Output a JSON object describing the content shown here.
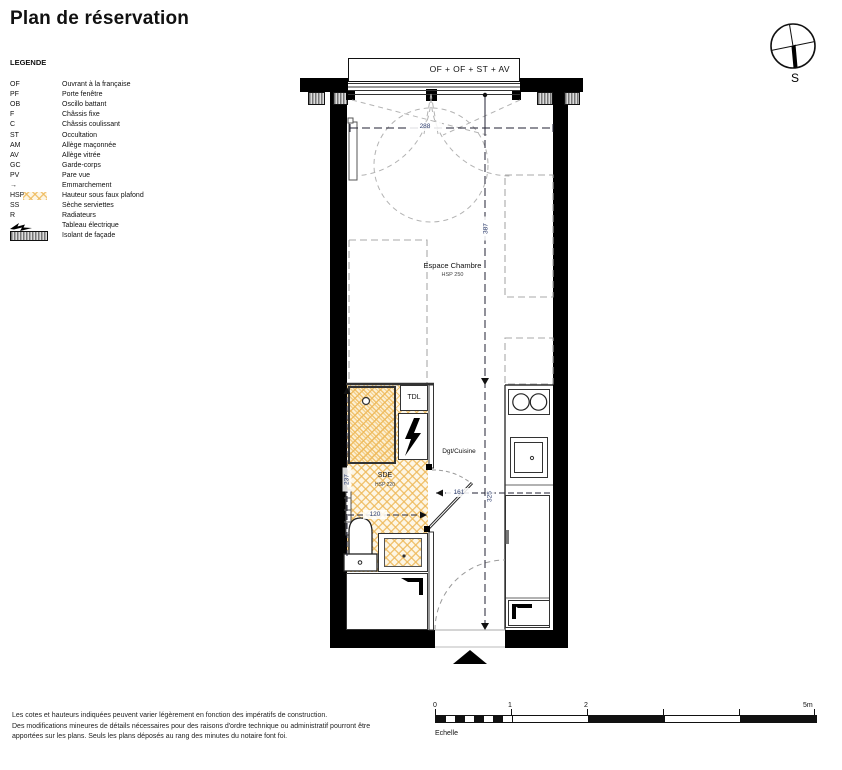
{
  "title": "Plan de réservation",
  "legend": {
    "heading": "LEGENDE",
    "items": [
      {
        "abbr": "OF",
        "label": "Ouvrant à la française"
      },
      {
        "abbr": "PF",
        "label": "Porte fenêtre"
      },
      {
        "abbr": "OB",
        "label": "Oscillo battant"
      },
      {
        "abbr": "F",
        "label": "Châssis fixe"
      },
      {
        "abbr": "C",
        "label": "Châssis coulissant"
      },
      {
        "abbr": "ST",
        "label": "Occultation"
      },
      {
        "abbr": "AM",
        "label": "Allège maçonnée"
      },
      {
        "abbr": "AV",
        "label": "Allège vitrée"
      },
      {
        "abbr": "GC",
        "label": "Garde-corps"
      },
      {
        "abbr": "PV",
        "label": "Pare vue"
      },
      {
        "abbr": "→",
        "label": "Emmarchement"
      },
      {
        "abbr": "HSP",
        "label": "Hauteur sous faux plafond"
      },
      {
        "abbr": "SS",
        "label": "Sèche serviettes"
      },
      {
        "abbr": "R",
        "label": "Radiateurs"
      },
      {
        "abbr": "",
        "label": "Tableau électrique"
      },
      {
        "abbr": "",
        "label": "Isolant de façade"
      }
    ]
  },
  "compass": {
    "south_label": "S"
  },
  "plan": {
    "window_label": "OF + OF + ST + AV",
    "rooms": {
      "chambre_name": "Espace Chambre",
      "chambre_hsp": "HSP 250",
      "sde_name": "SDE",
      "sde_hsp": "HSP 220",
      "dgt_name": "Dgt/Cuisine",
      "tdl_name": "TDL"
    },
    "dimensions": {
      "window_width": "288",
      "chambre_length": "387",
      "dgt_width": "161",
      "dgt_length": "325",
      "sde_length": "237",
      "sde_width": "120"
    }
  },
  "scalebar": {
    "label_0": "0",
    "label_1": "1",
    "label_2": "2",
    "label_5": "5m",
    "caption": "Echelle"
  },
  "footer": {
    "line1": "Les cotes et hauteurs indiquées peuvent varier légèrement en fonction des impératifs de construction.",
    "line2": "Des modifications mineures de détails nécessaires pour des raisons d'ordre technique ou administratif pourront être",
    "line3": "apportées sur les plans. Seuls les plans déposés au rang des minutes du notaire font foi.",
    "colors": {
      "wall": "#000000",
      "hsp_hatch": "#eeb95a",
      "dimension_text": "#2e3e6e"
    }
  }
}
